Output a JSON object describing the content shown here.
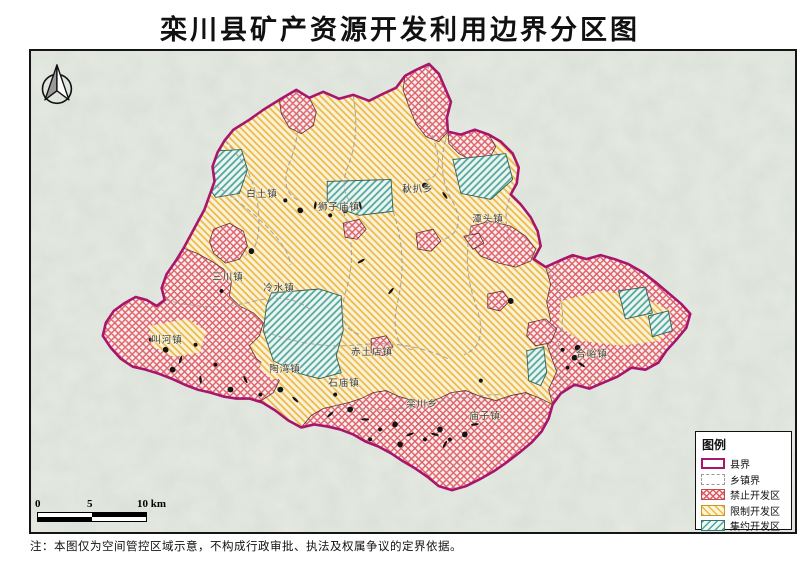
{
  "title": "栾川县矿产资源开发利用边界分区图",
  "note": "注：本图仅为空间管控区域示意，不构成行政审批、执法及权属争议的定界依据。",
  "legend": {
    "title": "图例",
    "items": [
      {
        "label": "县界",
        "type": "county-boundary"
      },
      {
        "label": "乡镇界",
        "type": "township-boundary"
      },
      {
        "label": "禁止开发区",
        "type": "prohibited-zone"
      },
      {
        "label": "限制开发区",
        "type": "restricted-zone"
      },
      {
        "label": "集约开发区",
        "type": "intensive-zone"
      }
    ]
  },
  "scalebar": {
    "labels": [
      "0",
      "5",
      "10 km"
    ]
  },
  "compass": "north-arrow",
  "towns": [
    {
      "name": "白土镇",
      "x": 231,
      "y": 142
    },
    {
      "name": "狮子庙镇",
      "x": 308,
      "y": 155
    },
    {
      "name": "秋扒乡",
      "x": 387,
      "y": 137
    },
    {
      "name": "潭头镇",
      "x": 457,
      "y": 167
    },
    {
      "name": "三川镇",
      "x": 197,
      "y": 225
    },
    {
      "name": "冷水镇",
      "x": 248,
      "y": 236
    },
    {
      "name": "叫河镇",
      "x": 136,
      "y": 288
    },
    {
      "name": "陶湾镇",
      "x": 254,
      "y": 317
    },
    {
      "name": "赤土店镇",
      "x": 341,
      "y": 300
    },
    {
      "name": "石庙镇",
      "x": 313,
      "y": 331
    },
    {
      "name": "栾川乡",
      "x": 391,
      "y": 352
    },
    {
      "name": "庙子镇",
      "x": 454,
      "y": 364
    },
    {
      "name": "合峪镇",
      "x": 561,
      "y": 302
    }
  ],
  "colors": {
    "county_boundary": "#a8156c",
    "township_boundary": "#9a9a9a",
    "prohibited_hatch": "#df5a62",
    "restricted_hatch": "#efb93f",
    "intensive_hatch": "#4aa79a",
    "terrain_base": "#e6eae2"
  }
}
